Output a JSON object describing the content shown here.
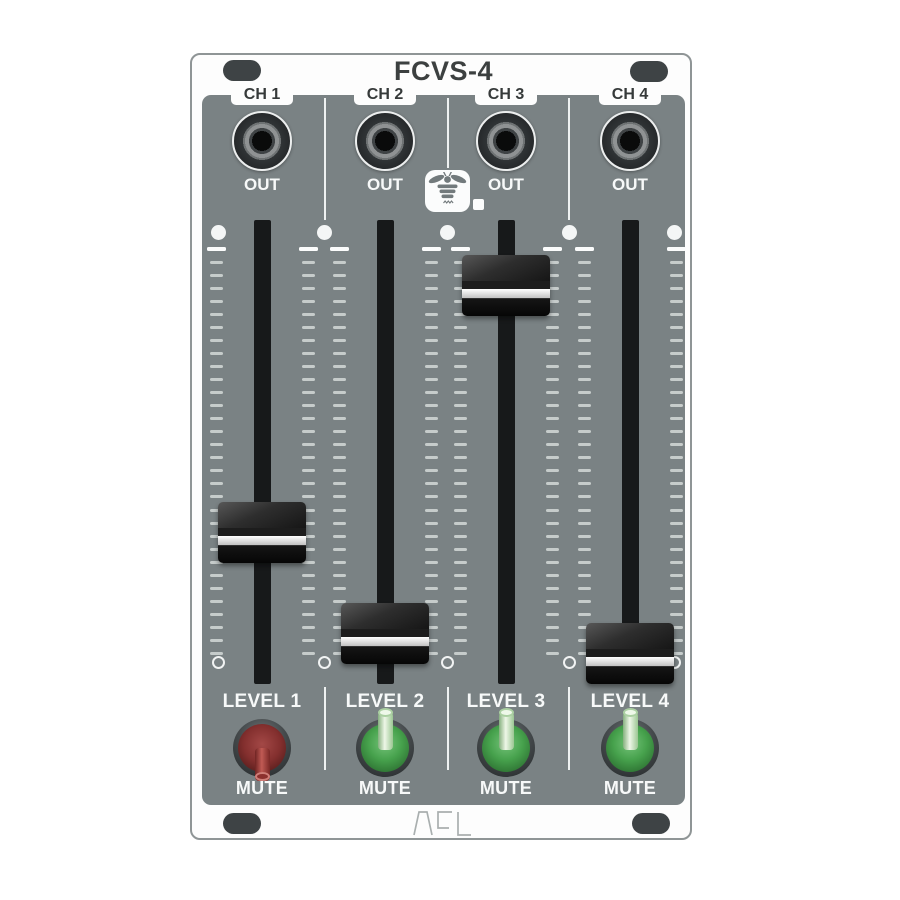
{
  "module": {
    "title": "FCVS-4",
    "brand_logo_text": "ACL",
    "panel_color": "#7a8284",
    "mute_active_color": "#832f2e",
    "mute_inactive_color": "#46a14c"
  },
  "icons": {
    "brand_icon": "bee-in-speech-bubble-icon",
    "corner_fixture": "mounting-screw-slot",
    "fader_guide_top": "white-dot-marker",
    "fader_guide_bottom": "open-circle-marker"
  },
  "channels": [
    {
      "ch_label": "CH 1",
      "out_label": "OUT",
      "level_label": "LEVEL 1",
      "mute_label": "MUTE",
      "fader_level_percent": 30,
      "switch_color": "red",
      "lever_direction": "down",
      "mute_engaged": true
    },
    {
      "ch_label": "CH 2",
      "out_label": "OUT",
      "level_label": "LEVEL 2",
      "mute_label": "MUTE",
      "fader_level_percent": 5,
      "switch_color": "green",
      "lever_direction": "up",
      "mute_engaged": false
    },
    {
      "ch_label": "CH 3",
      "out_label": "OUT",
      "level_label": "LEVEL 3",
      "mute_label": "MUTE",
      "fader_level_percent": 91,
      "switch_color": "green",
      "lever_direction": "up",
      "mute_engaged": false
    },
    {
      "ch_label": "CH 4",
      "out_label": "OUT",
      "level_label": "LEVEL 4",
      "mute_label": "MUTE",
      "fader_level_percent": 0,
      "switch_color": "green",
      "lever_direction": "up",
      "mute_engaged": false
    }
  ]
}
